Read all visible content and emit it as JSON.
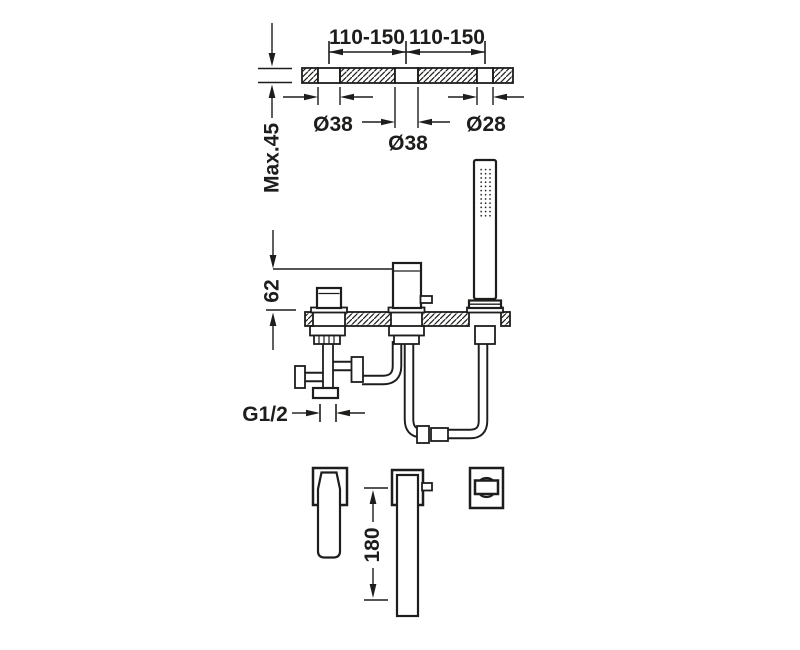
{
  "drawing": {
    "background": "#ffffff",
    "line_color": "#1d1d1b",
    "top_view": {
      "span_left_label": "110-150",
      "span_right_label": "110-150",
      "deck_max_thickness_label": "Max.45",
      "hole_left_diameter_label": "Ø38",
      "hole_center_diameter_label": "Ø38",
      "hole_right_diameter_label": "Ø28"
    },
    "section_view": {
      "spout_height_label": "62",
      "inlet_thread_label": "G1/2"
    },
    "plan_view": {
      "spout_projection_label": "180"
    }
  }
}
